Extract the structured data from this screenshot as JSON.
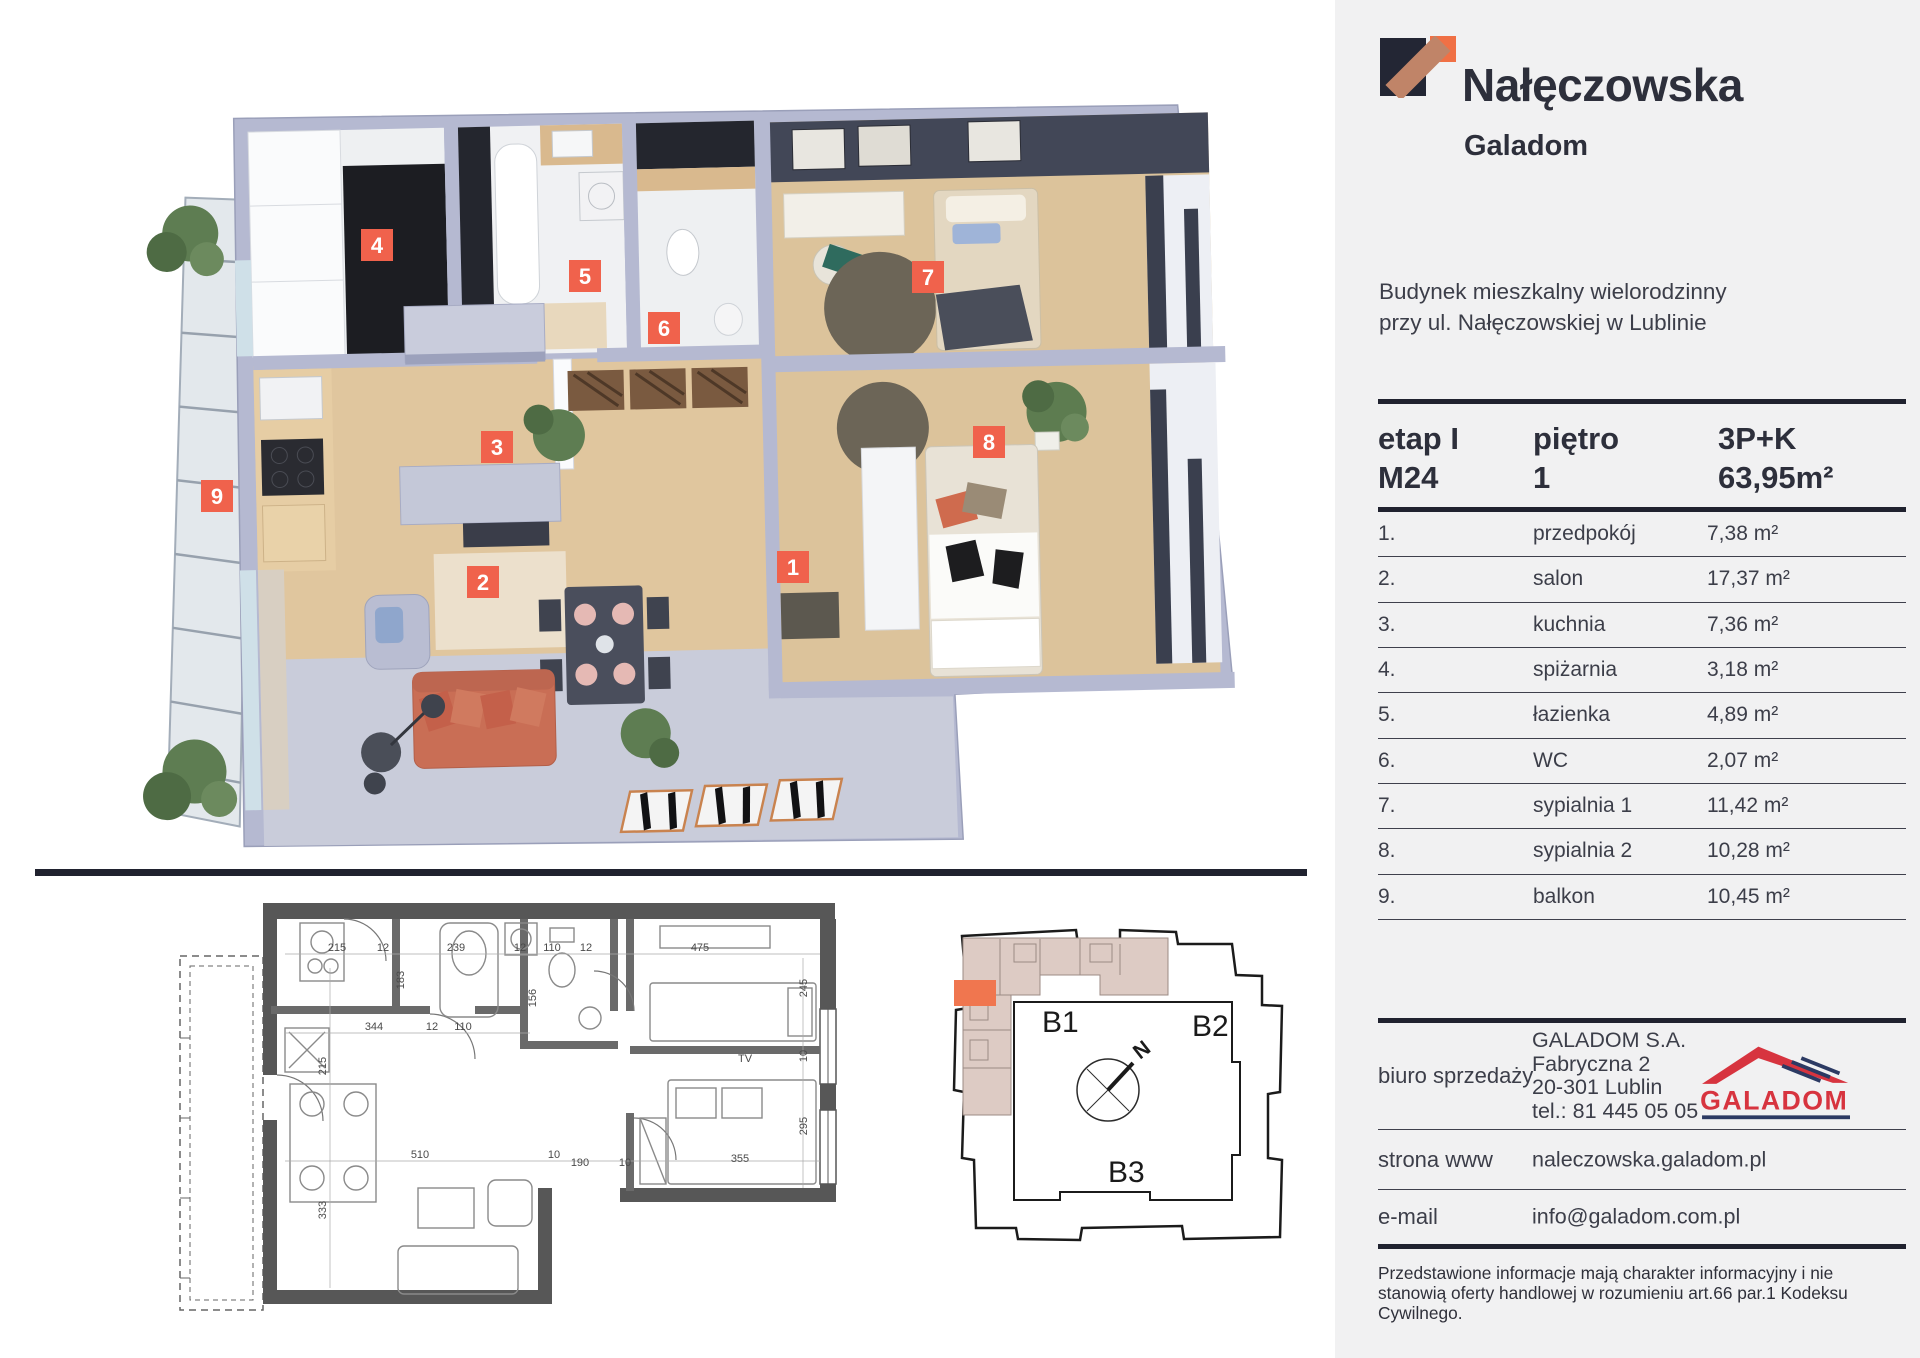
{
  "brand": {
    "title": "Nałęczowska",
    "subtitle": "Galadom"
  },
  "address": {
    "line1": "Budynek mieszkalny wielorodzinny",
    "line2": "przy ul. Nałęczowskiej w Lublinie"
  },
  "summary": {
    "etap_label": "etap I",
    "etap_value": "M24",
    "floor_label": "piętro",
    "floor_value": "1",
    "type": "3P+K",
    "area": "63,95m²"
  },
  "rooms": [
    {
      "no": "1.",
      "name": "przedpokój",
      "area": "7,38 m²"
    },
    {
      "no": "2.",
      "name": "salon",
      "area": "17,37 m²"
    },
    {
      "no": "3.",
      "name": "kuchnia",
      "area": "7,36 m²"
    },
    {
      "no": "4.",
      "name": "spiżarnia",
      "area": "3,18 m²"
    },
    {
      "no": "5.",
      "name": "łazienka",
      "area": "4,89 m²"
    },
    {
      "no": "6.",
      "name": "WC",
      "area": "2,07 m²"
    },
    {
      "no": "7.",
      "name": "sypialnia 1",
      "area": "11,42 m²"
    },
    {
      "no": "8.",
      "name": "sypialnia 2",
      "area": "10,28 m²"
    },
    {
      "no": "9.",
      "name": "balkon",
      "area": "10,45 m²"
    }
  ],
  "contact": {
    "office_label": "biuro sprzedaży",
    "company": "GALADOM S.A.",
    "street": "Fabryczna 2",
    "city": "20-301 Lublin",
    "phone": "tel.: 81 445 05 05",
    "www_label": "strona www",
    "www": "naleczowska.galadom.pl",
    "email_label": "e-mail",
    "email": "info@galadom.com.pl",
    "logo_text": "GALADOM"
  },
  "disclaimer": "Przedstawione informacje mają charakter informacyjny i nie stanowią oferty handlowej w rozumieniu art.66 par.1 Kodeksu Cywilnego.",
  "plan3d": {
    "badges": [
      {
        "n": "1",
        "x": 793,
        "y": 567
      },
      {
        "n": "2",
        "x": 483,
        "y": 582
      },
      {
        "n": "3",
        "x": 497,
        "y": 447
      },
      {
        "n": "4",
        "x": 377,
        "y": 245
      },
      {
        "n": "5",
        "x": 585,
        "y": 276
      },
      {
        "n": "6",
        "x": 664,
        "y": 328
      },
      {
        "n": "7",
        "x": 928,
        "y": 277
      },
      {
        "n": "8",
        "x": 989,
        "y": 442
      },
      {
        "n": "9",
        "x": 217,
        "y": 496
      }
    ]
  },
  "plan2d": {
    "dims": [
      {
        "t": "215",
        "x": 337,
        "y": 953,
        "r": 0
      },
      {
        "t": "12",
        "x": 383,
        "y": 953,
        "r": 0
      },
      {
        "t": "239",
        "x": 456,
        "y": 953,
        "r": 0
      },
      {
        "t": "12",
        "x": 520,
        "y": 953,
        "r": 0
      },
      {
        "t": "110",
        "x": 552,
        "y": 953,
        "r": 0
      },
      {
        "t": "12",
        "x": 586,
        "y": 953,
        "r": 0
      },
      {
        "t": "475",
        "x": 700,
        "y": 953,
        "r": 0
      },
      {
        "t": "183",
        "x": 404,
        "y": 982,
        "r": 90
      },
      {
        "t": "156",
        "x": 536,
        "y": 1000,
        "r": 90
      },
      {
        "t": "245",
        "x": 807,
        "y": 990,
        "r": 90
      },
      {
        "t": "344",
        "x": 374,
        "y": 1032,
        "r": 0
      },
      {
        "t": "12",
        "x": 432,
        "y": 1032,
        "r": 0
      },
      {
        "t": "110",
        "x": 463,
        "y": 1032,
        "r": 0
      },
      {
        "t": "215",
        "x": 326,
        "y": 1068,
        "r": 90
      },
      {
        "t": "10",
        "x": 807,
        "y": 1058,
        "r": 90
      },
      {
        "t": "295",
        "x": 807,
        "y": 1128,
        "r": 90
      },
      {
        "t": "510",
        "x": 420,
        "y": 1160,
        "r": 0
      },
      {
        "t": "10",
        "x": 554,
        "y": 1160,
        "r": 0
      },
      {
        "t": "190",
        "x": 580,
        "y": 1168,
        "r": 0
      },
      {
        "t": "10",
        "x": 625,
        "y": 1168,
        "r": 0
      },
      {
        "t": "355",
        "x": 740,
        "y": 1164,
        "r": 0
      },
      {
        "t": "333",
        "x": 326,
        "y": 1212,
        "r": 90
      },
      {
        "t": "TV",
        "x": 745,
        "y": 1064,
        "r": 0
      }
    ]
  },
  "siteplan": {
    "b1": "B1",
    "b2": "B2",
    "b3": "B3",
    "north": "N"
  },
  "colors": {
    "accent": "#f0624c",
    "line": "#20222f",
    "brand_navy": "#232634",
    "brand_salmon": "#c08468",
    "brand_orange": "#f07045",
    "galadom_red": "#d7343f",
    "galadom_navy": "#2c3a63",
    "site_highlight": "#f0764f",
    "panel_bg": "#f1f1f2"
  }
}
